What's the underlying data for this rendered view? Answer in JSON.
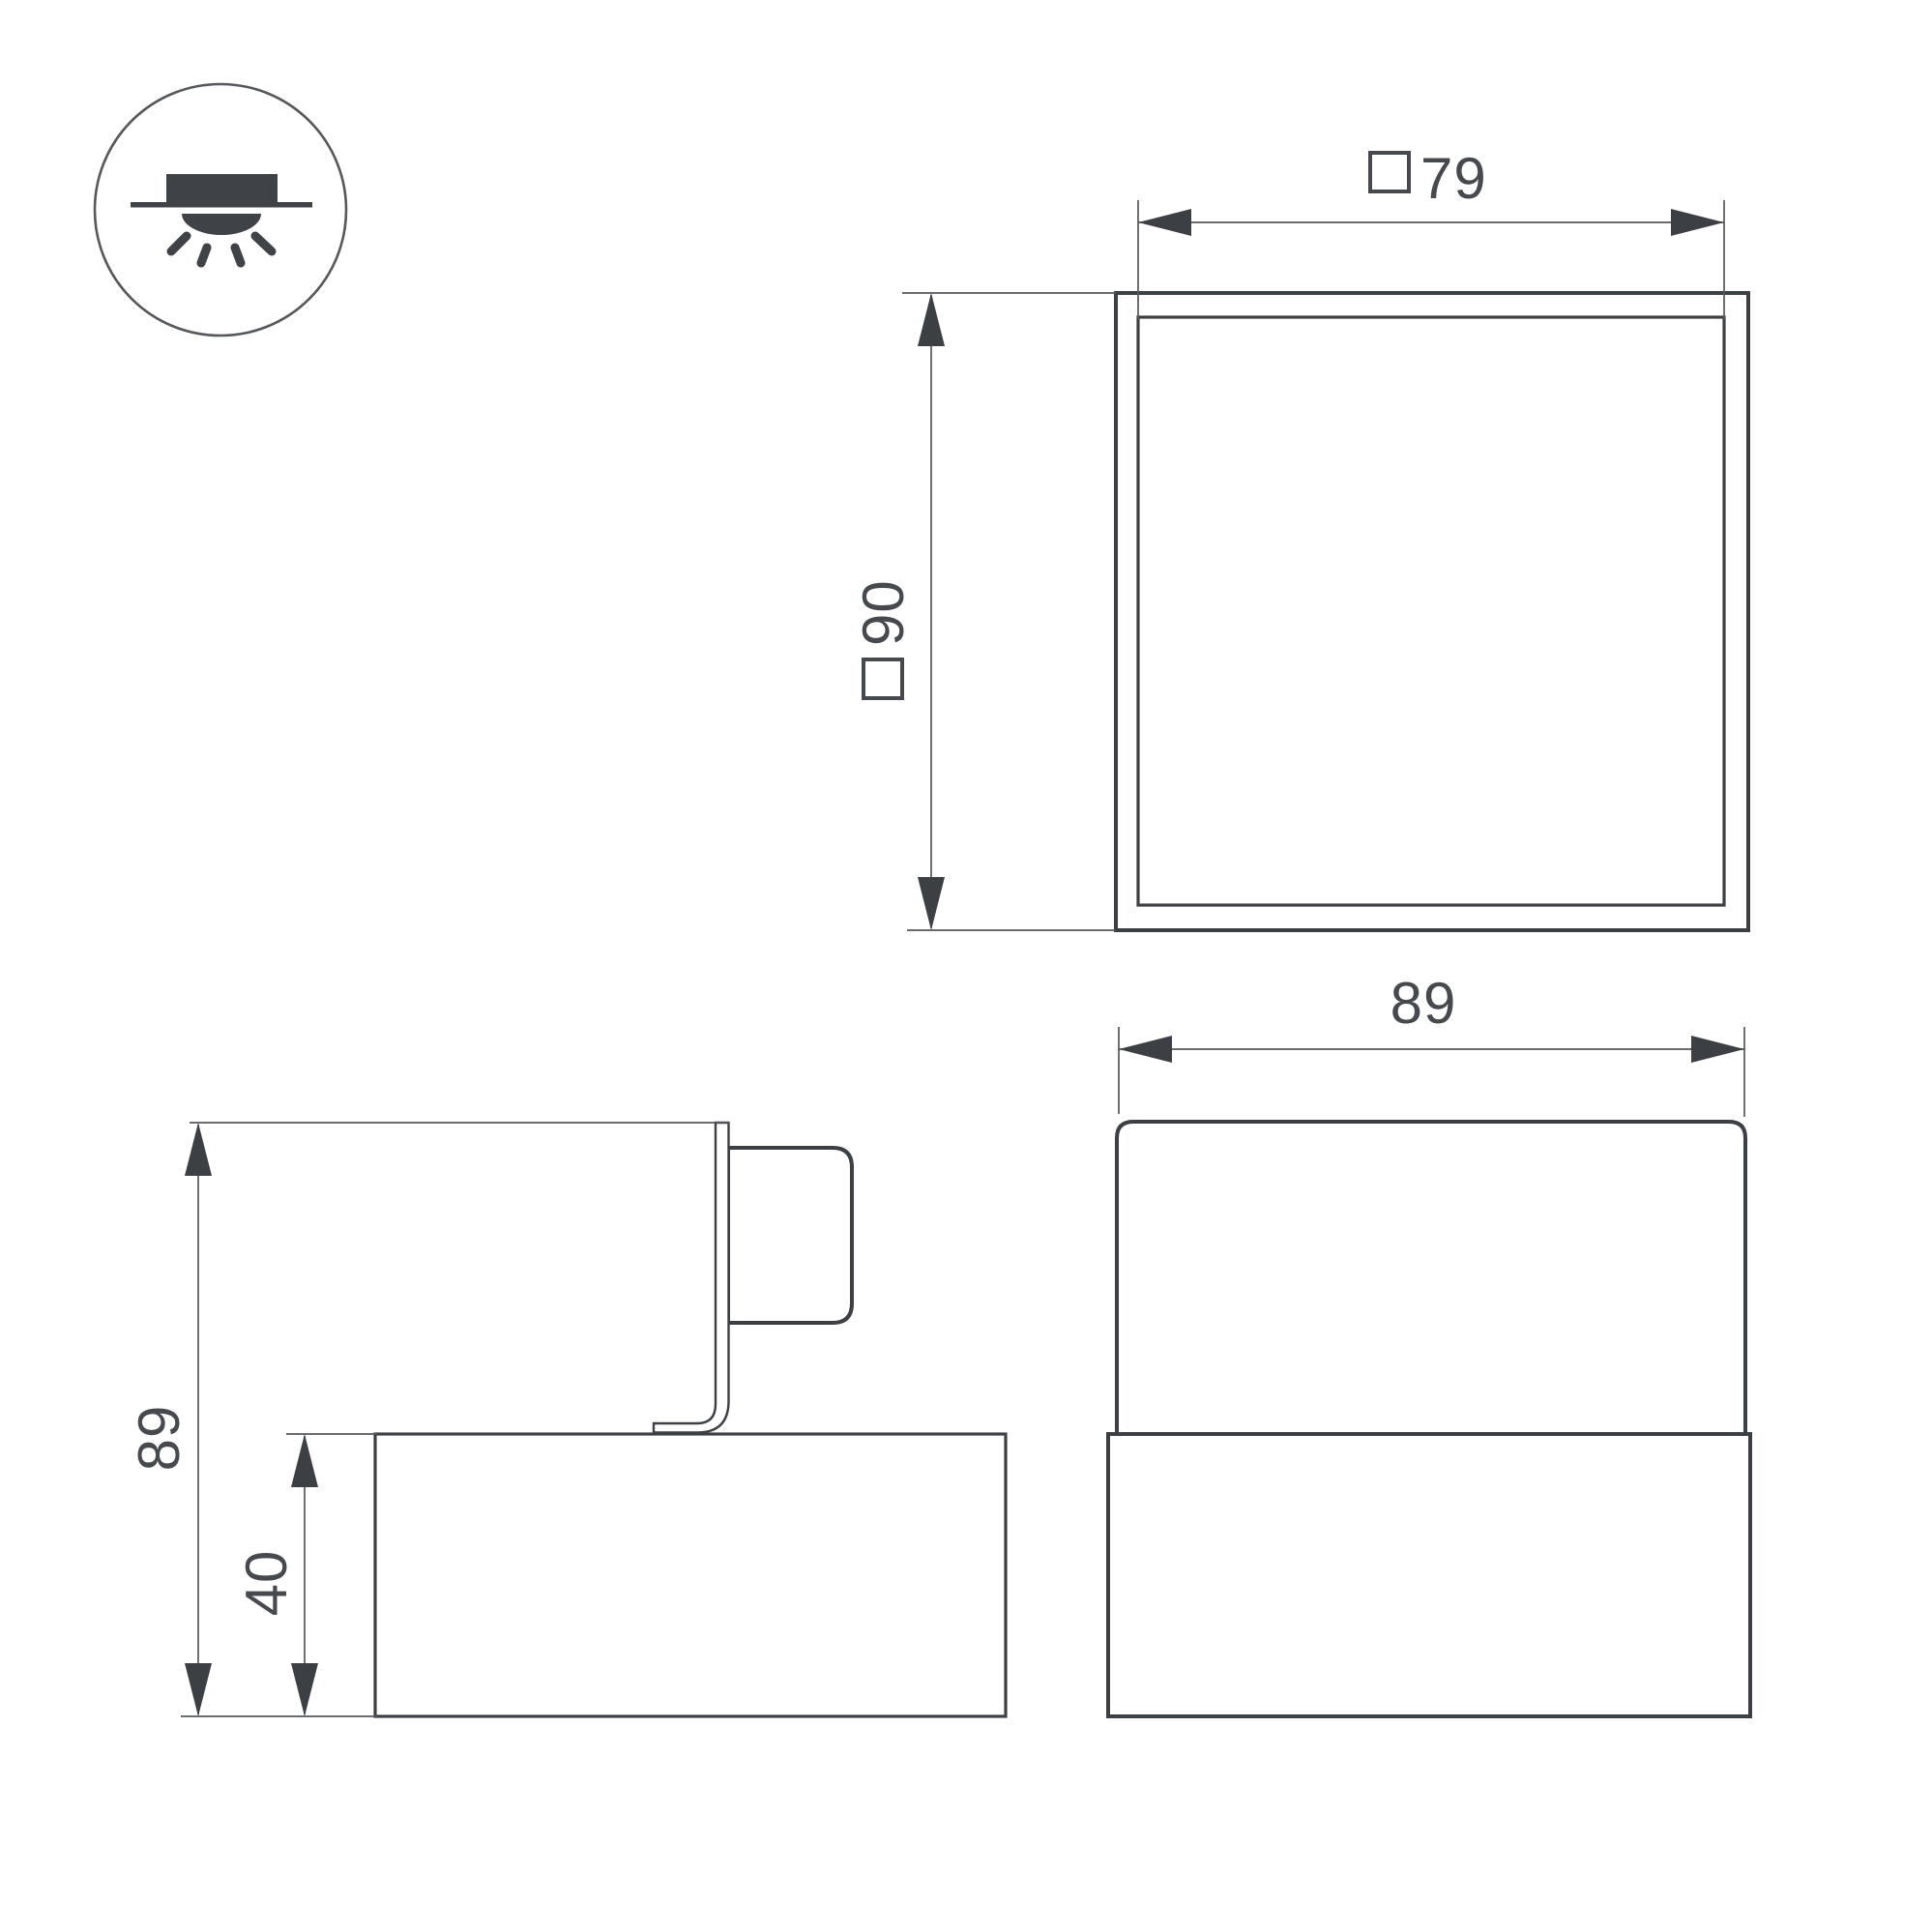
{
  "drawing": {
    "icon": {
      "name": "recessed-ceiling-light-icon"
    },
    "views": {
      "top": {
        "width": {
          "square_prefix": true,
          "value": "79"
        },
        "size": {
          "square_prefix": true,
          "value": "90"
        }
      },
      "side": {
        "height": "89",
        "base_height": "40"
      },
      "front": {
        "width": "89"
      }
    },
    "colors": {
      "line": "#3c3f44",
      "thin_line": "#55585c",
      "text": "#46494e",
      "background": "#ffffff"
    }
  }
}
